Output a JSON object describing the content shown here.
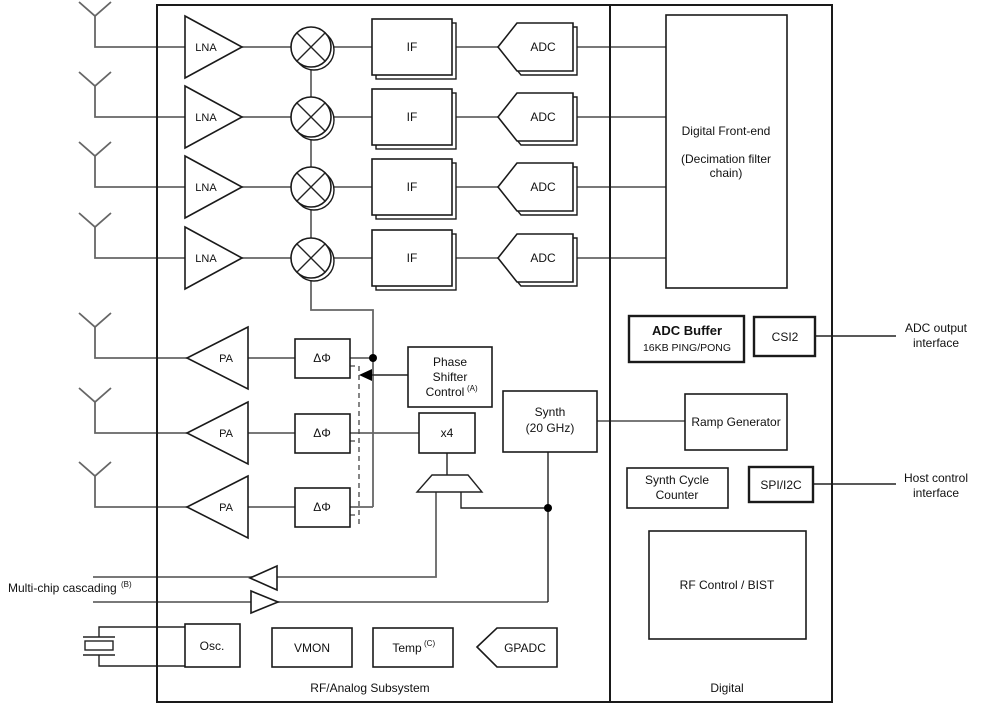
{
  "sections": {
    "rf_analog": "RF/Analog Subsystem",
    "digital": "Digital"
  },
  "blocks": {
    "lna": "LNA",
    "pa": "PA",
    "if": "IF",
    "adc": "ADC",
    "delta_phi": "ΔΦ",
    "dfe_title": "Digital Front-end",
    "dfe_sub1": "(Decimation filter",
    "dfe_sub2": "chain)",
    "phase_shifter_1": "Phase",
    "phase_shifter_2": "Shifter",
    "phase_shifter_3": "Control",
    "phase_shifter_sup": "(A)",
    "x4": "x4",
    "synth_1": "Synth",
    "synth_2": "(20 GHz)",
    "adc_buffer_title": "ADC Buffer",
    "adc_buffer_sub": "16KB PING/PONG",
    "csi2": "CSI2",
    "ramp_generator": "Ramp Generator",
    "synth_cycle_1": "Synth Cycle",
    "synth_cycle_2": "Counter",
    "spi_i2c": "SPI/I2C",
    "rf_control_bist": "RF Control / BIST",
    "osc": "Osc.",
    "vmon": "VMON",
    "temp": "Temp",
    "temp_sup": "(C)",
    "gpadc": "GPADC"
  },
  "annotations": {
    "cascade": "Multi-chip cascading",
    "cascade_sup": "(B)",
    "adc_output_1": "ADC output",
    "adc_output_2": "interface",
    "host_control_1": "Host control",
    "host_control_2": "interface"
  },
  "colors": {
    "wire": "#666666",
    "outline": "#1a1a1a",
    "background": "#ffffff"
  }
}
